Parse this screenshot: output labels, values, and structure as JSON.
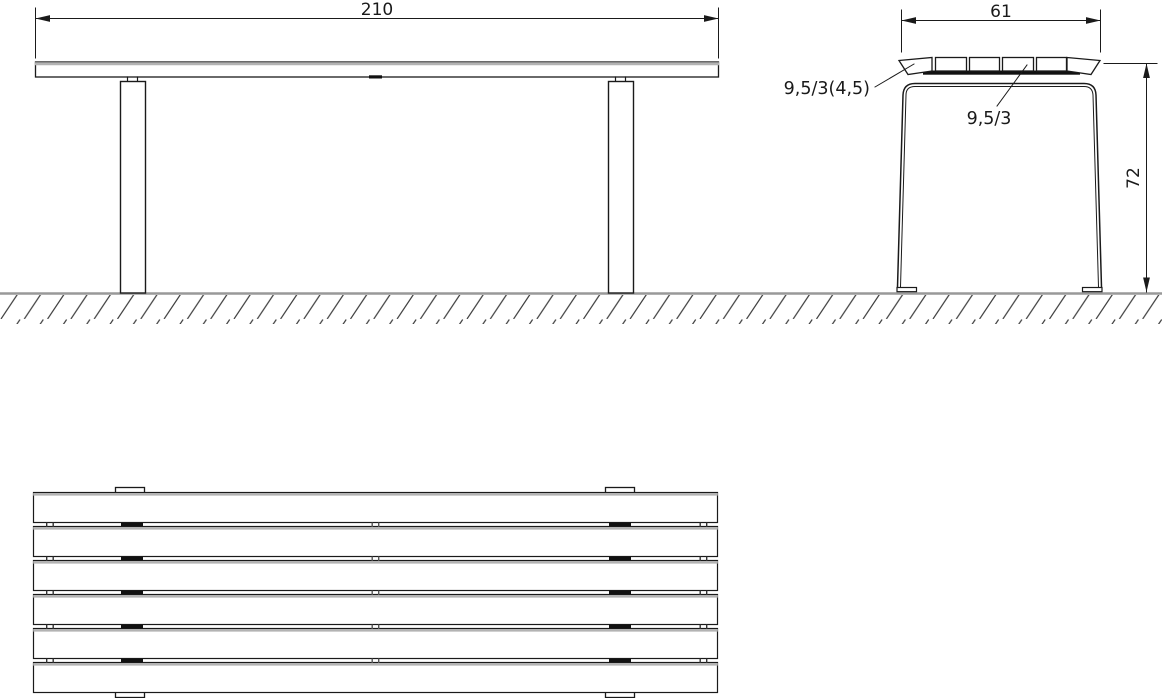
{
  "views": {
    "front": {
      "width_dim": "210"
    },
    "side": {
      "depth_dim": "61",
      "height_dim": "72",
      "edge_slat_label": "9,5/3(4,5)",
      "mid_slat_label": "9,5/3"
    }
  },
  "colors": {
    "line": "#1a1a1a",
    "gray_accent": "#b3b3b3",
    "ground_line": "#999999",
    "hatch": "#3f3f3f"
  }
}
